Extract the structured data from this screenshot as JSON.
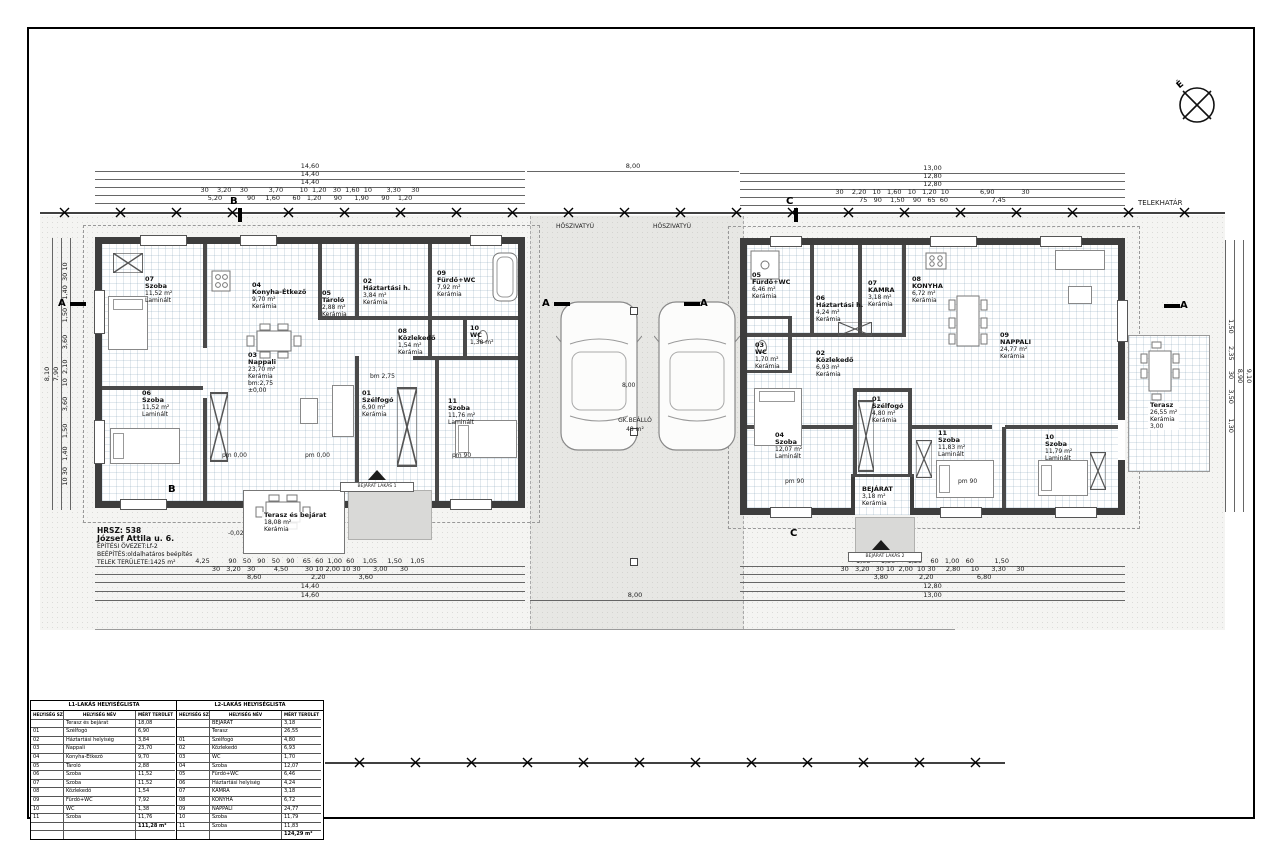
{
  "sheet": {
    "north": "É",
    "telekhatar": "TELEKHATÁR",
    "heatpump": "HŐSZIVATYÚ",
    "parking_label": "GK.BEÁLLÓ",
    "parking_area": "48 m²",
    "levels": {
      "zero": "±0,00",
      "terrace": "-0,02"
    }
  },
  "info": {
    "l1": "HRSZ: 538",
    "l2": "József Attila u. 6.",
    "l3": "ÉPÍTÉSI ÖVEZET:Lf-2",
    "l4": "BEÉPÍTÉS:oldalhatáros beépítés",
    "l5": "TELEK TERÜLETE:1425 m²"
  },
  "markers": {
    "a": "A",
    "b": "B",
    "c": "C"
  },
  "dims": {
    "lt1": "14,60",
    "lt2": "14,40",
    "lt3": "14,40",
    "lt4": "30    3,20    30          3,70        10  1,20   30  1,60  10       3,30     30",
    "lt5": "5,20            90     1,60      60   1,20      90      1,90      90    1,20",
    "mt": "8,00",
    "rt1": "13,00",
    "rt2": "12,80",
    "rt3": "12,80",
    "rt4": "30    2,20   10   1,60   10   1,20  10               6,90             30",
    "rt5": "75   90    1,50    90   65  60                     7,45",
    "lb1": "4,25         90   50   90   50   90    65  60  1,00  60    1,05     1,50    1,05",
    "lb2": "30   3,20   30         4,50        30 10 2,00 10 30      3,00      30",
    "lb3": "8,60                        2,20                3,60",
    "lb4": "14,40",
    "lb5": "14,60",
    "rb1": "1,05     1,50      1,25    60   1,00   60          1,50",
    "rb2": "30   3,20   30 10  2,00  10 30     2,80     10      3,30     30",
    "rb3": "3,80               2,20                     6,80",
    "rb4": "12,80",
    "rb5": "13,00",
    "mb": "8,00",
    "lv_total1": "8,10",
    "lv_total2": "7,90",
    "lv_seg": "10 30   1,40    1,50      3,60     10  2,10     3,60      1,50    1,40  30 10",
    "rv_total1": "9,10",
    "rv_total2": "8,90",
    "rv_seg": "1,50      2,35     30     3,50       1,30",
    "bm": "bm 2,75",
    "pm0": "pm 0,00",
    "pm90": "pm 90"
  },
  "buildings": {
    "left": {
      "rooms": [
        {
          "num": "07",
          "name": "Szoba",
          "area": "11,52 m²",
          "mat": "Laminált",
          "extra": "",
          "extra2": ""
        },
        {
          "num": "04",
          "name": "Konyha-Étkező",
          "area": "9,70 m²",
          "mat": "Kerámia",
          "extra": "",
          "extra2": ""
        },
        {
          "num": "05",
          "name": "Tároló",
          "area": "2,88 m²",
          "mat": "Kerámia",
          "extra": "",
          "extra2": ""
        },
        {
          "num": "02",
          "name": "Háztartási h.",
          "area": "3,84 m²",
          "mat": "Kerámia",
          "extra": "",
          "extra2": ""
        },
        {
          "num": "09",
          "name": "Fürdő+WC",
          "area": "7,92 m²",
          "mat": "Kerámia",
          "extra": "",
          "extra2": ""
        },
        {
          "num": "08",
          "name": "Közlekedő",
          "area": "1,54 m²",
          "mat": "Kerámia",
          "extra": "",
          "extra2": ""
        },
        {
          "num": "10",
          "name": "WC",
          "area": "1,38 m²",
          "mat": "",
          "extra": "",
          "extra2": ""
        },
        {
          "num": "03",
          "name": "Nappali",
          "area": "23,70 m²",
          "mat": "Kerámia",
          "extra": "bm:2,75",
          "extra2": "±0,00"
        },
        {
          "num": "06",
          "name": "Szoba",
          "area": "11,52 m²",
          "mat": "Laminált",
          "extra": "",
          "extra2": ""
        },
        {
          "num": "01",
          "name": "Szélfogó",
          "area": "6,90 m²",
          "mat": "Kerámia",
          "extra": "",
          "extra2": ""
        },
        {
          "num": "11",
          "name": "Szoba",
          "area": "11,76 m²",
          "mat": "Laminált",
          "extra": "",
          "extra2": ""
        }
      ]
    },
    "right": {
      "rooms": [
        {
          "num": "05",
          "name": "Fürdő+WC",
          "area": "6,46 m²",
          "mat": "Kerámia"
        },
        {
          "num": "06",
          "name": "Háztartási h.",
          "area": "4,24 m²",
          "mat": "Kerámia"
        },
        {
          "num": "07",
          "name": "KAMRA",
          "area": "3,18 m²",
          "mat": "Kerámia"
        },
        {
          "num": "08",
          "name": "KONYHA",
          "area": "6,72 m²",
          "mat": "Kerámia"
        },
        {
          "num": "03",
          "name": "WC",
          "area": "1,70 m²",
          "mat": "Kerámia"
        },
        {
          "num": "02",
          "name": "Közlekedő",
          "area": "6,93 m²",
          "mat": "Kerámia"
        },
        {
          "num": "09",
          "name": "NAPPALI",
          "area": "24,77 m²",
          "mat": "Kerámia"
        },
        {
          "num": "01",
          "name": "Szélfogó",
          "area": "4,80 m²",
          "mat": "Kerámia"
        },
        {
          "num": "04",
          "name": "Szoba",
          "area": "12,07 m²",
          "mat": "Laminált"
        },
        {
          "num": "11",
          "name": "Szoba",
          "area": "11,83 m²",
          "mat": "Laminált"
        },
        {
          "num": "10",
          "name": "Szoba",
          "area": "11,79 m²",
          "mat": "Laminált"
        },
        {
          "num": "",
          "name": "BEJÁRAT",
          "area": "3,18 m²",
          "mat": "Kerámia"
        }
      ]
    }
  },
  "terraces": {
    "left": {
      "name": "Terasz és bejárat",
      "area": "18,08 m²",
      "mat": "Kerámia",
      "entry": "BEJÁRAT LAKÁS 1"
    },
    "right": {
      "name": "Terasz",
      "area": "26,55 m²",
      "mat": "Kerámia",
      "dim": "3,00",
      "entry": "BEJÁRAT LAKÁS 2"
    }
  },
  "tables": {
    "l1": {
      "title": "L1-LAKÁS HELYISÉGLISTA",
      "headers": [
        "HELYISÉG SZÁM",
        "HELYISÉG NÉV",
        "MÉRT TERÜLET"
      ],
      "rows": [
        [
          "",
          "Terasz és bejárat",
          "18,08"
        ],
        [
          "01",
          "Szélfogó",
          "6,90"
        ],
        [
          "02",
          "Háztartási helyiség",
          "3,84"
        ],
        [
          "03",
          "Nappali",
          "23,70"
        ],
        [
          "04",
          "Konyha-Étkező",
          "9,70"
        ],
        [
          "05",
          "Tároló",
          "2,88"
        ],
        [
          "06",
          "Szoba",
          "11,52"
        ],
        [
          "07",
          "Szoba",
          "11,52"
        ],
        [
          "08",
          "Közlekedő",
          "1,54"
        ],
        [
          "09",
          "Fürdő+WC",
          "7,92"
        ],
        [
          "10",
          "WC",
          "1,38"
        ],
        [
          "11",
          "Szoba",
          "11,76"
        ]
      ],
      "total": "111,28 m²"
    },
    "l2": {
      "title": "L2-LAKÁS HELYISÉGLISTA",
      "headers": [
        "HELYISÉG SZÁM",
        "HELYISÉG NÉV",
        "MÉRT TERÜLET"
      ],
      "rows": [
        [
          "",
          "BEJÁRAT",
          "3,18"
        ],
        [
          "",
          "Terasz",
          "26,55"
        ],
        [
          "01",
          "Szélfogó",
          "4,80"
        ],
        [
          "02",
          "Közlekedő",
          "6,93"
        ],
        [
          "03",
          "WC",
          "1,70"
        ],
        [
          "04",
          "Szoba",
          "12,07"
        ],
        [
          "05",
          "Fürdő+WC",
          "6,46"
        ],
        [
          "06",
          "Háztartási helyiség",
          "4,24"
        ],
        [
          "07",
          "KAMRA",
          "3,18"
        ],
        [
          "08",
          "KONYHA",
          "6,72"
        ],
        [
          "09",
          "NAPPALI",
          "24,77"
        ],
        [
          "10",
          "Szoba",
          "11,79"
        ],
        [
          "11",
          "Szoba",
          "11,83"
        ]
      ],
      "total": "124,29 m²"
    }
  }
}
